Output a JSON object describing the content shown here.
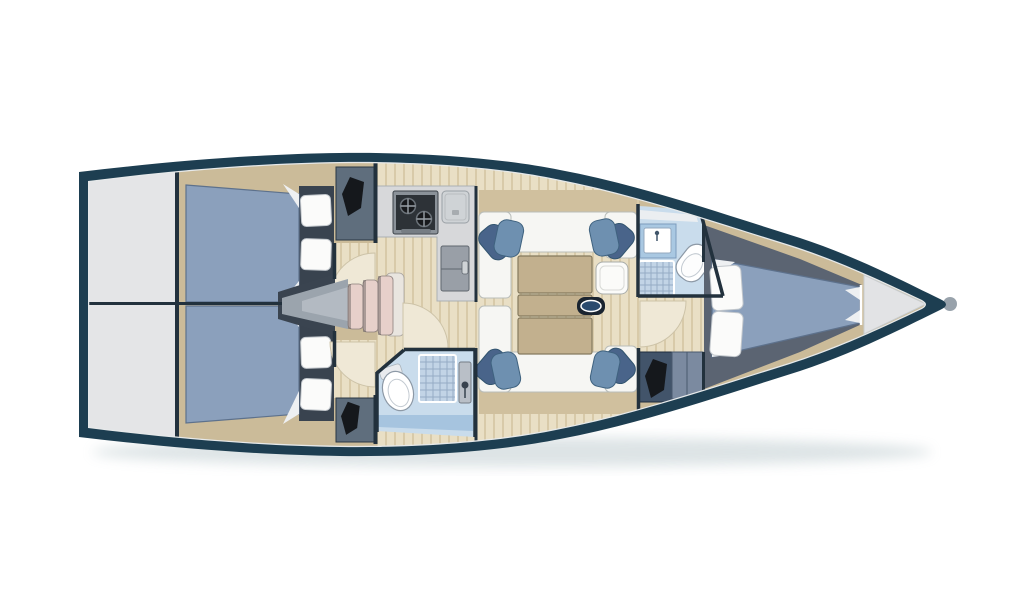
{
  "meta": {
    "title": "Sailing yacht interior layout — top-view floor plan (bow right, stern left)"
  },
  "palette": {
    "hull": "#1d3e51",
    "hull_highlight": "#e6e9ea",
    "deck": "#e4e5e7",
    "cabinetry": "#cbbb99",
    "backrest": "#d0c09e",
    "floor": "#e9dfc5",
    "floor_stripe": "#d8caa9",
    "bed": "#8ba0bc",
    "bed_edge": "#5d718c",
    "pillow": "#fbfbfa",
    "headboard": "#39434f",
    "settee": "#f6f6f3",
    "cushion": "#6e90b0",
    "cushion_dark": "#49648a",
    "table": "#c2b08e",
    "table_edge": "#857a5e",
    "side_table": "#fbfbf9",
    "counter": "#d7d8da",
    "stove": "#8b9299",
    "stove_panel": "#2d3237",
    "fridge": "#999fa7",
    "sink": "#cfd3d6",
    "bath_floor": "#c9dcec",
    "bath_deep": "#a6c4df",
    "grate": "#c2d4e6",
    "grate_line": "#8fa6c0",
    "white": "#ffffff",
    "wardrobe": "#5f6e7d",
    "wardrobe_navy": "#42546a",
    "cabinet": "#7b8aa0",
    "clothes": "#15181c",
    "steps": "#e7d0ca",
    "step_pale": "#e9e5df",
    "step_shadow": "#6e6664",
    "companionway": "#9ba4ad",
    "companionway_light": "#b7bec6",
    "companionway_dark": "#3a4450",
    "platform_dark": "#5b6472",
    "wall": "#22313d",
    "handle_plate": "#1a2430",
    "handle": "#2a4a6e",
    "door_arc": "#efe8d6",
    "bow_locker": "#e2e3e5",
    "fold": "#eef0f2",
    "shadow": "#9fb2b8",
    "bow_fitting": "#98a2ab"
  },
  "rooms": [
    {
      "id": "stern-platform",
      "label": "Stern platform / transom locker"
    },
    {
      "id": "aft-cabin-port",
      "label": "Aft double cabin (port)"
    },
    {
      "id": "aft-cabin-starboard",
      "label": "Aft double cabin (starboard)"
    },
    {
      "id": "companionway",
      "label": "Companionway steps"
    },
    {
      "id": "galley",
      "label": "Galley with stove, sink and fridge"
    },
    {
      "id": "aft-heads",
      "label": "Aft heads with shower"
    },
    {
      "id": "salon",
      "label": "Salon with facing settees and table"
    },
    {
      "id": "fwd-heads",
      "label": "Forward heads with shower"
    },
    {
      "id": "fwd-cabin",
      "label": "Forward V-berth cabin"
    },
    {
      "id": "bow-locker",
      "label": "Anchor locker"
    }
  ],
  "fixtures": {
    "double_berths": 3,
    "pillows": 8,
    "settees": 2,
    "seat_cushions": 4,
    "stove_burners": 2,
    "toilets": 2,
    "shower_grates": 2,
    "hanging_lockers": 3,
    "cabinets": 1,
    "companionway_steps": 4,
    "door_swings": 4,
    "saloon_table_leaves": 3
  }
}
